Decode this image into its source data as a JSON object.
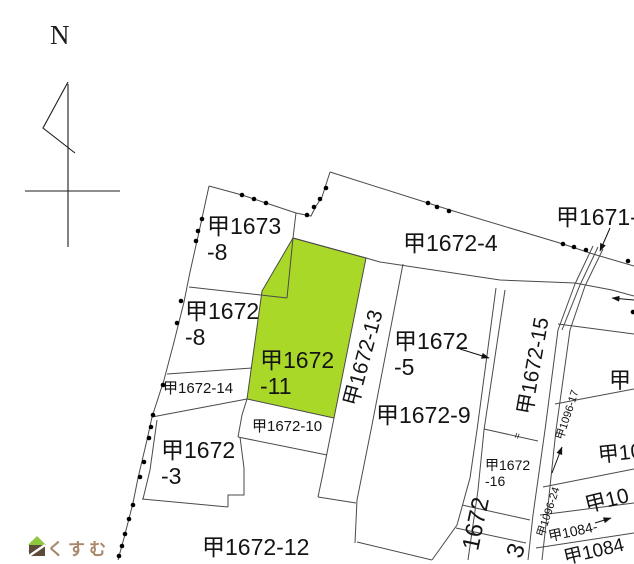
{
  "map": {
    "title_hint": "cadastral parcel map",
    "compass": {
      "label": "N"
    },
    "watermark": {
      "text": "らくすむ"
    },
    "colors": {
      "background": "#ffffff",
      "highlight_parcel": "#aad828",
      "boundary_line": "#4a4a4a",
      "dot": "#000000",
      "label_text": "#141414",
      "logo_text": "#a8886a",
      "logo_green": "#8dc63f",
      "logo_brown": "#5d4a38"
    },
    "highlighted_parcel_id": "甲1672-11",
    "labels": [
      {
        "name": "label-parcel-1673-8",
        "lines": [
          "甲1673",
          "-8"
        ],
        "x": 207,
        "y": 214,
        "fs": 23
      },
      {
        "name": "label-parcel-1672-8",
        "lines": [
          "甲1672",
          "-8"
        ],
        "x": 185,
        "y": 299,
        "fs": 23
      },
      {
        "name": "label-parcel-1672-11",
        "lines": [
          "甲1672",
          "-11"
        ],
        "x": 260,
        "y": 348,
        "fs": 23
      },
      {
        "name": "label-parcel-1672-4",
        "lines": [
          "甲1672-4"
        ],
        "x": 403,
        "y": 231,
        "fs": 23
      },
      {
        "name": "label-parcel-1671",
        "lines": [
          "甲1671-"
        ],
        "x": 556,
        "y": 205,
        "fs": 23
      },
      {
        "name": "label-parcel-1672-5",
        "lines": [
          "甲1672",
          "-5"
        ],
        "x": 394,
        "y": 329,
        "fs": 23
      },
      {
        "name": "label-parcel-1672-9",
        "lines": [
          "甲1672-9"
        ],
        "x": 376,
        "y": 403,
        "fs": 23
      },
      {
        "name": "label-parcel-1672-13",
        "lines": [
          "甲1672-13"
        ],
        "x": 364,
        "y": 358,
        "fs": 21,
        "rot": -75,
        "center": true
      },
      {
        "name": "label-parcel-1672-15",
        "lines": [
          "甲1672-15"
        ],
        "x": 534,
        "y": 366,
        "fs": 21,
        "rot": -80,
        "center": true
      },
      {
        "name": "label-parcel-1672-14",
        "lines": [
          "甲1672-14"
        ],
        "x": 163,
        "y": 381,
        "fs": 15
      },
      {
        "name": "label-parcel-1672-10",
        "lines": [
          "甲1672-10"
        ],
        "x": 252,
        "y": 419,
        "fs": 15
      },
      {
        "name": "label-parcel-1672-3",
        "lines": [
          "甲1672",
          "-3"
        ],
        "x": 161,
        "y": 438,
        "fs": 23
      },
      {
        "name": "label-parcel-1672-12",
        "lines": [
          "甲1672-12"
        ],
        "x": 202,
        "y": 535,
        "fs": 23
      },
      {
        "name": "label-parcel-1672-16",
        "lines": [
          "甲1672",
          "-16"
        ],
        "x": 485,
        "y": 458,
        "fs": 14
      },
      {
        "name": "label-parcel-1096-17",
        "lines": [
          "甲1096-17"
        ],
        "x": 568,
        "y": 415,
        "fs": 11,
        "rot": -72,
        "center": true
      },
      {
        "name": "label-parcel-1096-24",
        "lines": [
          "甲1096-24"
        ],
        "x": 549,
        "y": 512,
        "fs": 11,
        "rot": -72,
        "center": true
      },
      {
        "name": "label-fragment-ko",
        "lines": [
          "甲"
        ],
        "x": 609,
        "y": 369,
        "fs": 22
      },
      {
        "name": "label-fragment-ko10",
        "lines": [
          "甲10"
        ],
        "x": 598,
        "y": 442,
        "fs": 21,
        "rot": -6
      },
      {
        "name": "label-fragment-ko10-rotated",
        "lines": [
          "甲10"
        ],
        "x": 607,
        "y": 501,
        "fs": 21,
        "rot": -14,
        "center": true
      },
      {
        "name": "label-fragment-1084-dash",
        "lines": [
          "甲1084-"
        ],
        "x": 573,
        "y": 532,
        "fs": 14,
        "rot": -12,
        "center": true
      },
      {
        "name": "label-fragment-1084",
        "lines": [
          "甲1084"
        ],
        "x": 594,
        "y": 552,
        "fs": 19,
        "rot": -13,
        "center": true
      },
      {
        "name": "label-fragment-1672",
        "lines": [
          "1672"
        ],
        "x": 477,
        "y": 524,
        "fs": 24,
        "rot": -78,
        "center": true
      },
      {
        "name": "label-fragment-3",
        "lines": [
          "3"
        ],
        "x": 517,
        "y": 551,
        "fs": 24,
        "rot": -70,
        "center": true
      },
      {
        "name": "tick-symbol",
        "lines": [
          "="
        ],
        "x": 518,
        "y": 436,
        "fs": 10,
        "rot": -70,
        "center": true
      }
    ],
    "geometry": {
      "green_polygon": "293,238 366,258 334,418 247,399 262,291",
      "solid_lines": [
        "209,186 242,195 266,203 296,213",
        "296,213 311,216 316,206 322,197 330,172",
        "330,172 450,210 563,244 593,254 634,266",
        "209,186 199,232 190,272 184,302 174,342 164,380 152,417 147,440 138,478 133,503 124,538 118,560",
        "296,213 293,238 287,298",
        "189,287 287,298",
        "293,238 366,258 380,262 500,280 575,283 612,290 634,296",
        "403,264 372,425 357,500 355,543",
        "496,288 477,430 470,478 457,525 432,560",
        "505,290 484,430 478,490 468,560",
        "575,284 558,330 545,430 533,515 528,560",
        "585,286 570,330 556,430 547,515 542,560",
        "593,246 575,284",
        "603,249 585,286",
        "598,247 580,285 562,330",
        "558,324 634,334",
        "555,404 634,389",
        "543,487 634,469",
        "540,515 634,503",
        "536,548 634,533",
        "484,429 538,441",
        "462,505 530,520",
        "456,528 526,543",
        "334,418 322,478 318,497",
        "318,497 356,503",
        "238,437 327,455",
        "247,399 242,415 238,437",
        "167,374 252,368",
        "152,417 247,399",
        "240,437 244,468 244,495 228,495 228,507",
        "228,507 142,499",
        "157,420 150,470 143,499",
        "357,542 432,560"
      ],
      "dots": [
        [
          242,
          195
        ],
        [
          254,
          199
        ],
        [
          266,
          203
        ],
        [
          307,
          215
        ],
        [
          314,
          207
        ],
        [
          320,
          199
        ],
        [
          326,
          188
        ],
        [
          428,
          203
        ],
        [
          437,
          207
        ],
        [
          449,
          211
        ],
        [
          563,
          244
        ],
        [
          574,
          247
        ],
        [
          586,
          250
        ],
        [
          628,
          261
        ],
        [
          633,
          312
        ],
        [
          202,
          219
        ],
        [
          198,
          231
        ],
        [
          196,
          241
        ],
        [
          181,
          301
        ],
        [
          177,
          323
        ],
        [
          163,
          385
        ],
        [
          153,
          415
        ],
        [
          151,
          427
        ],
        [
          149,
          438
        ],
        [
          144,
          462
        ],
        [
          140,
          477
        ],
        [
          133,
          505
        ],
        [
          129,
          519
        ],
        [
          125,
          534
        ],
        [
          122,
          546
        ],
        [
          119,
          556
        ]
      ],
      "arrows": [
        "610,228 600,251",
        "634,300 612,298",
        "460,349 489,358",
        "552,473 562,447",
        "595,523 611,518"
      ],
      "compass_lines": [
        "68,84 68,247",
        "25,191 120,191",
        "68,82 43,128 75,153"
      ]
    }
  }
}
